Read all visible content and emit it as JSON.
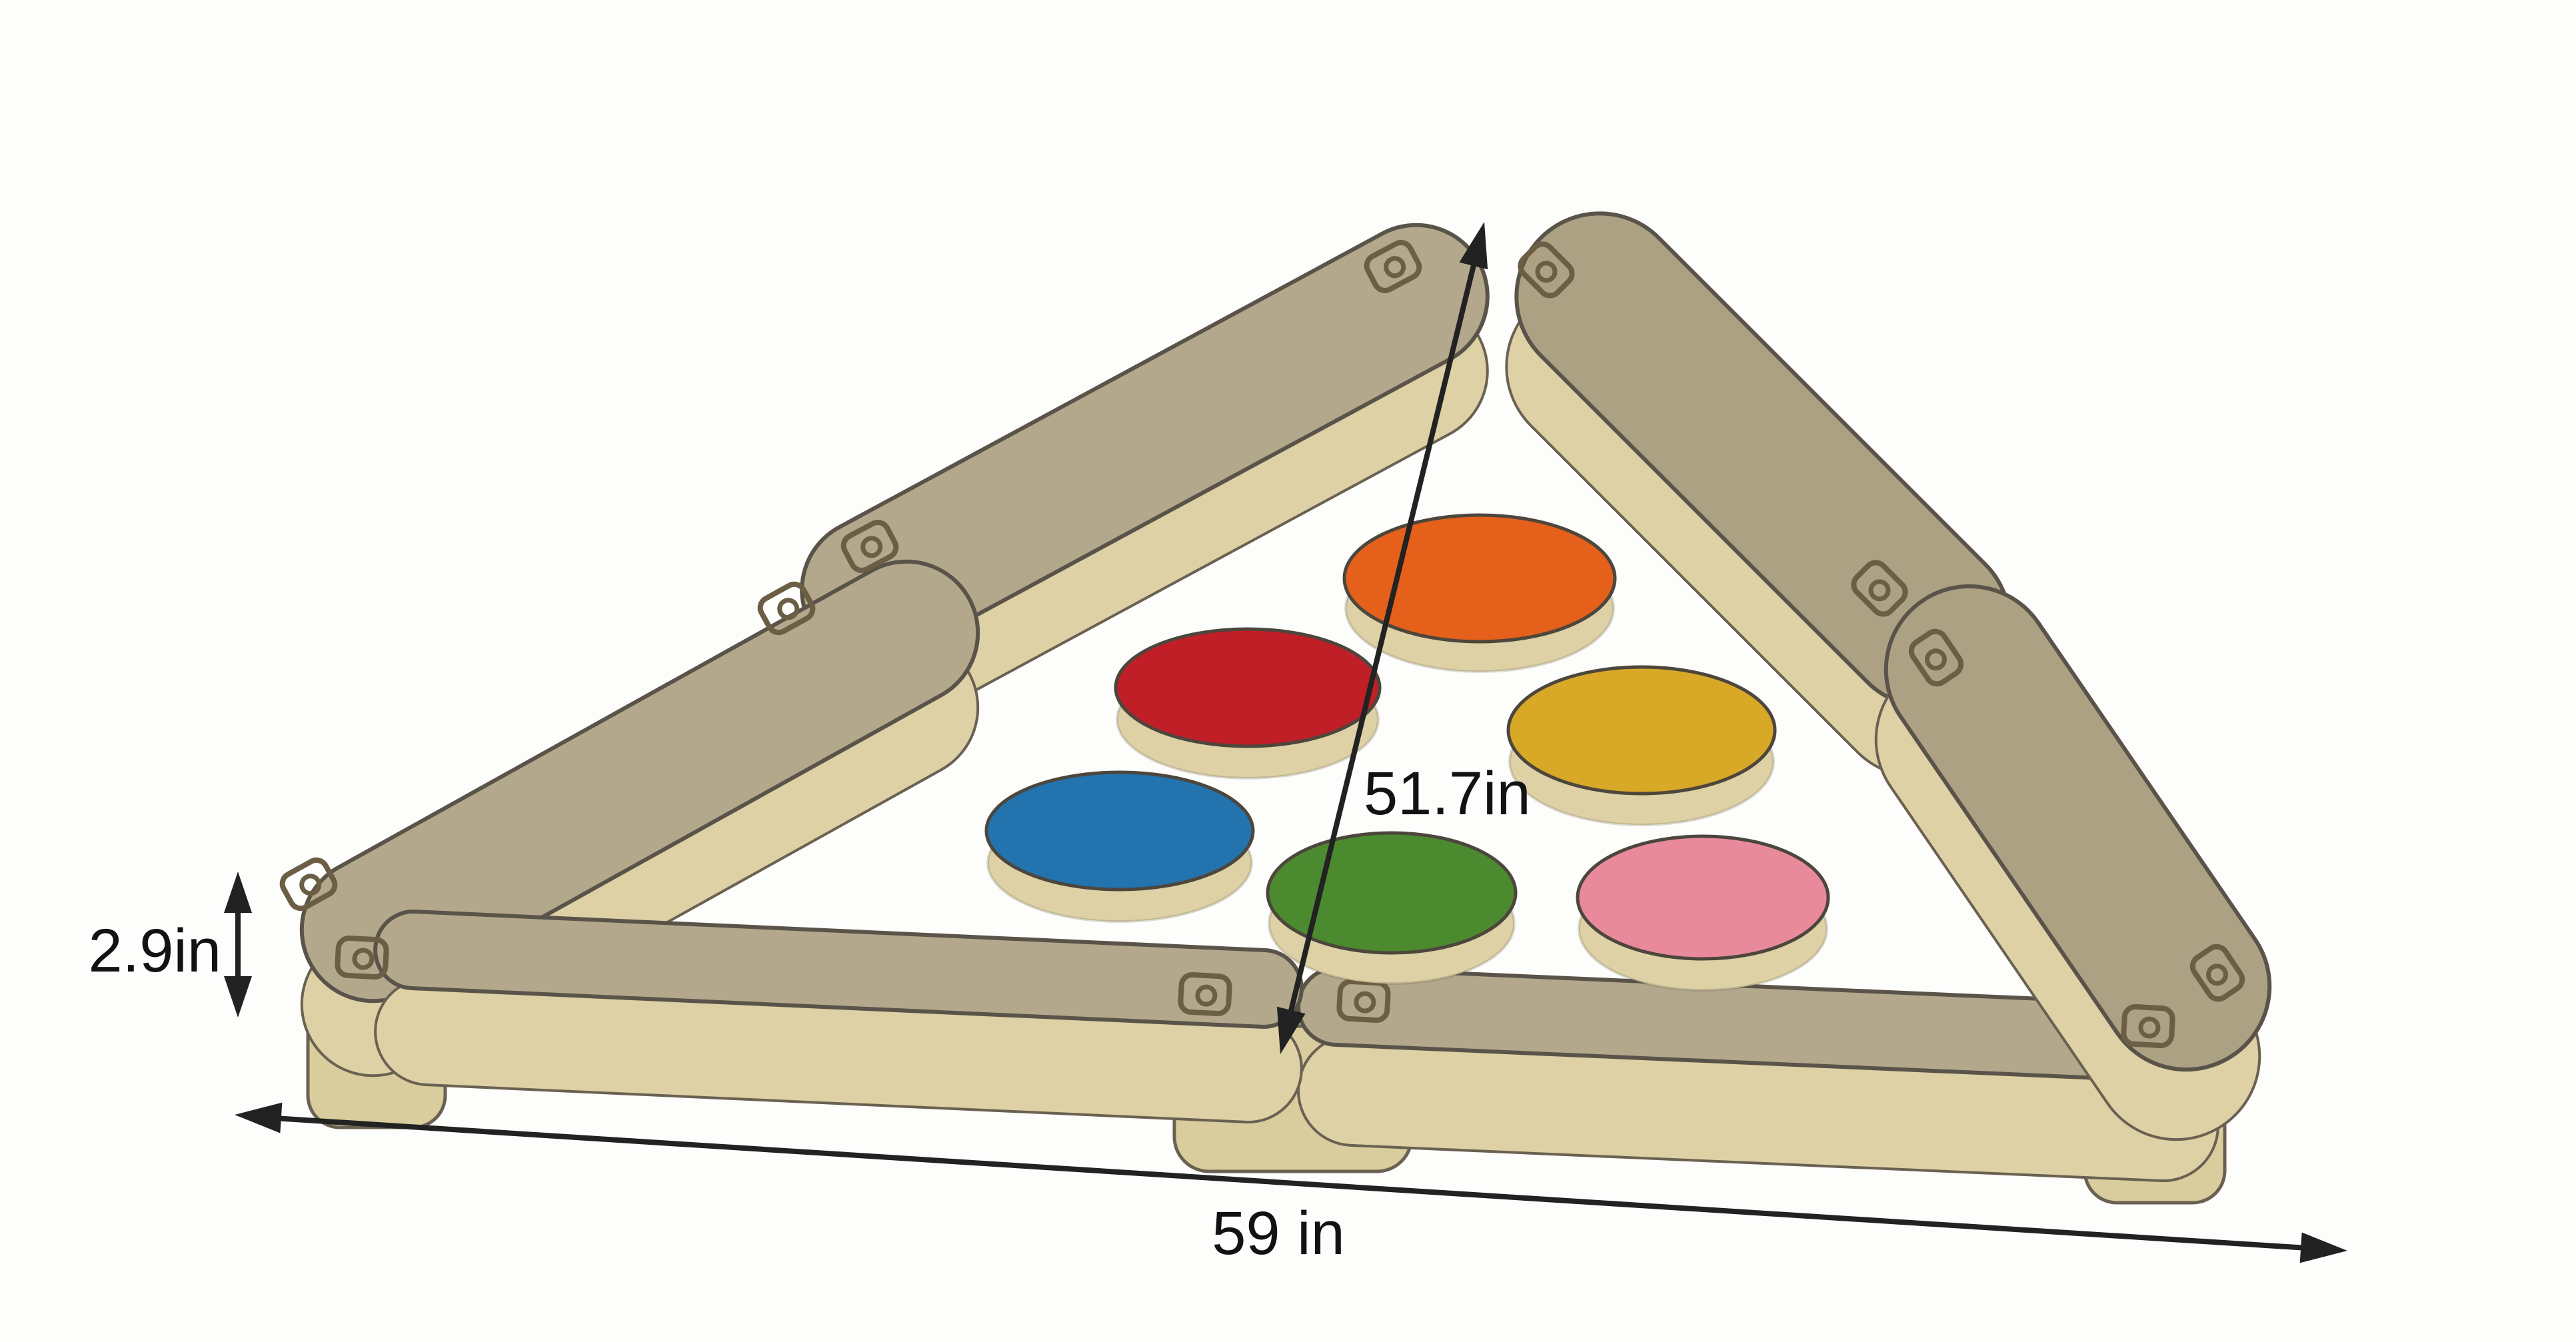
{
  "diagram": {
    "subject": "wooden-triangle-balance-beam-with-stepping-discs",
    "background": "#fdfdfb"
  },
  "dimensions": {
    "height_label": "2.9in",
    "diagonal_label": "51.7in",
    "base_label": "59 in"
  },
  "colors": {
    "wood_top": "#b3a88c",
    "wood_top_right": "#aca183",
    "wood_side": "#ddd1a5",
    "wood_foot": "#d9cd9e",
    "screw": "#6b5e45",
    "arrow": "#222222",
    "text": "#121212"
  },
  "discs": [
    {
      "name": "orange",
      "color": "#e4601b"
    },
    {
      "name": "red",
      "color": "#c01f28"
    },
    {
      "name": "yellow",
      "color": "#d8a827"
    },
    {
      "name": "blue",
      "color": "#2273ae"
    },
    {
      "name": "green",
      "color": "#4b8a2f"
    },
    {
      "name": "pink",
      "color": "#e88a9b"
    }
  ]
}
